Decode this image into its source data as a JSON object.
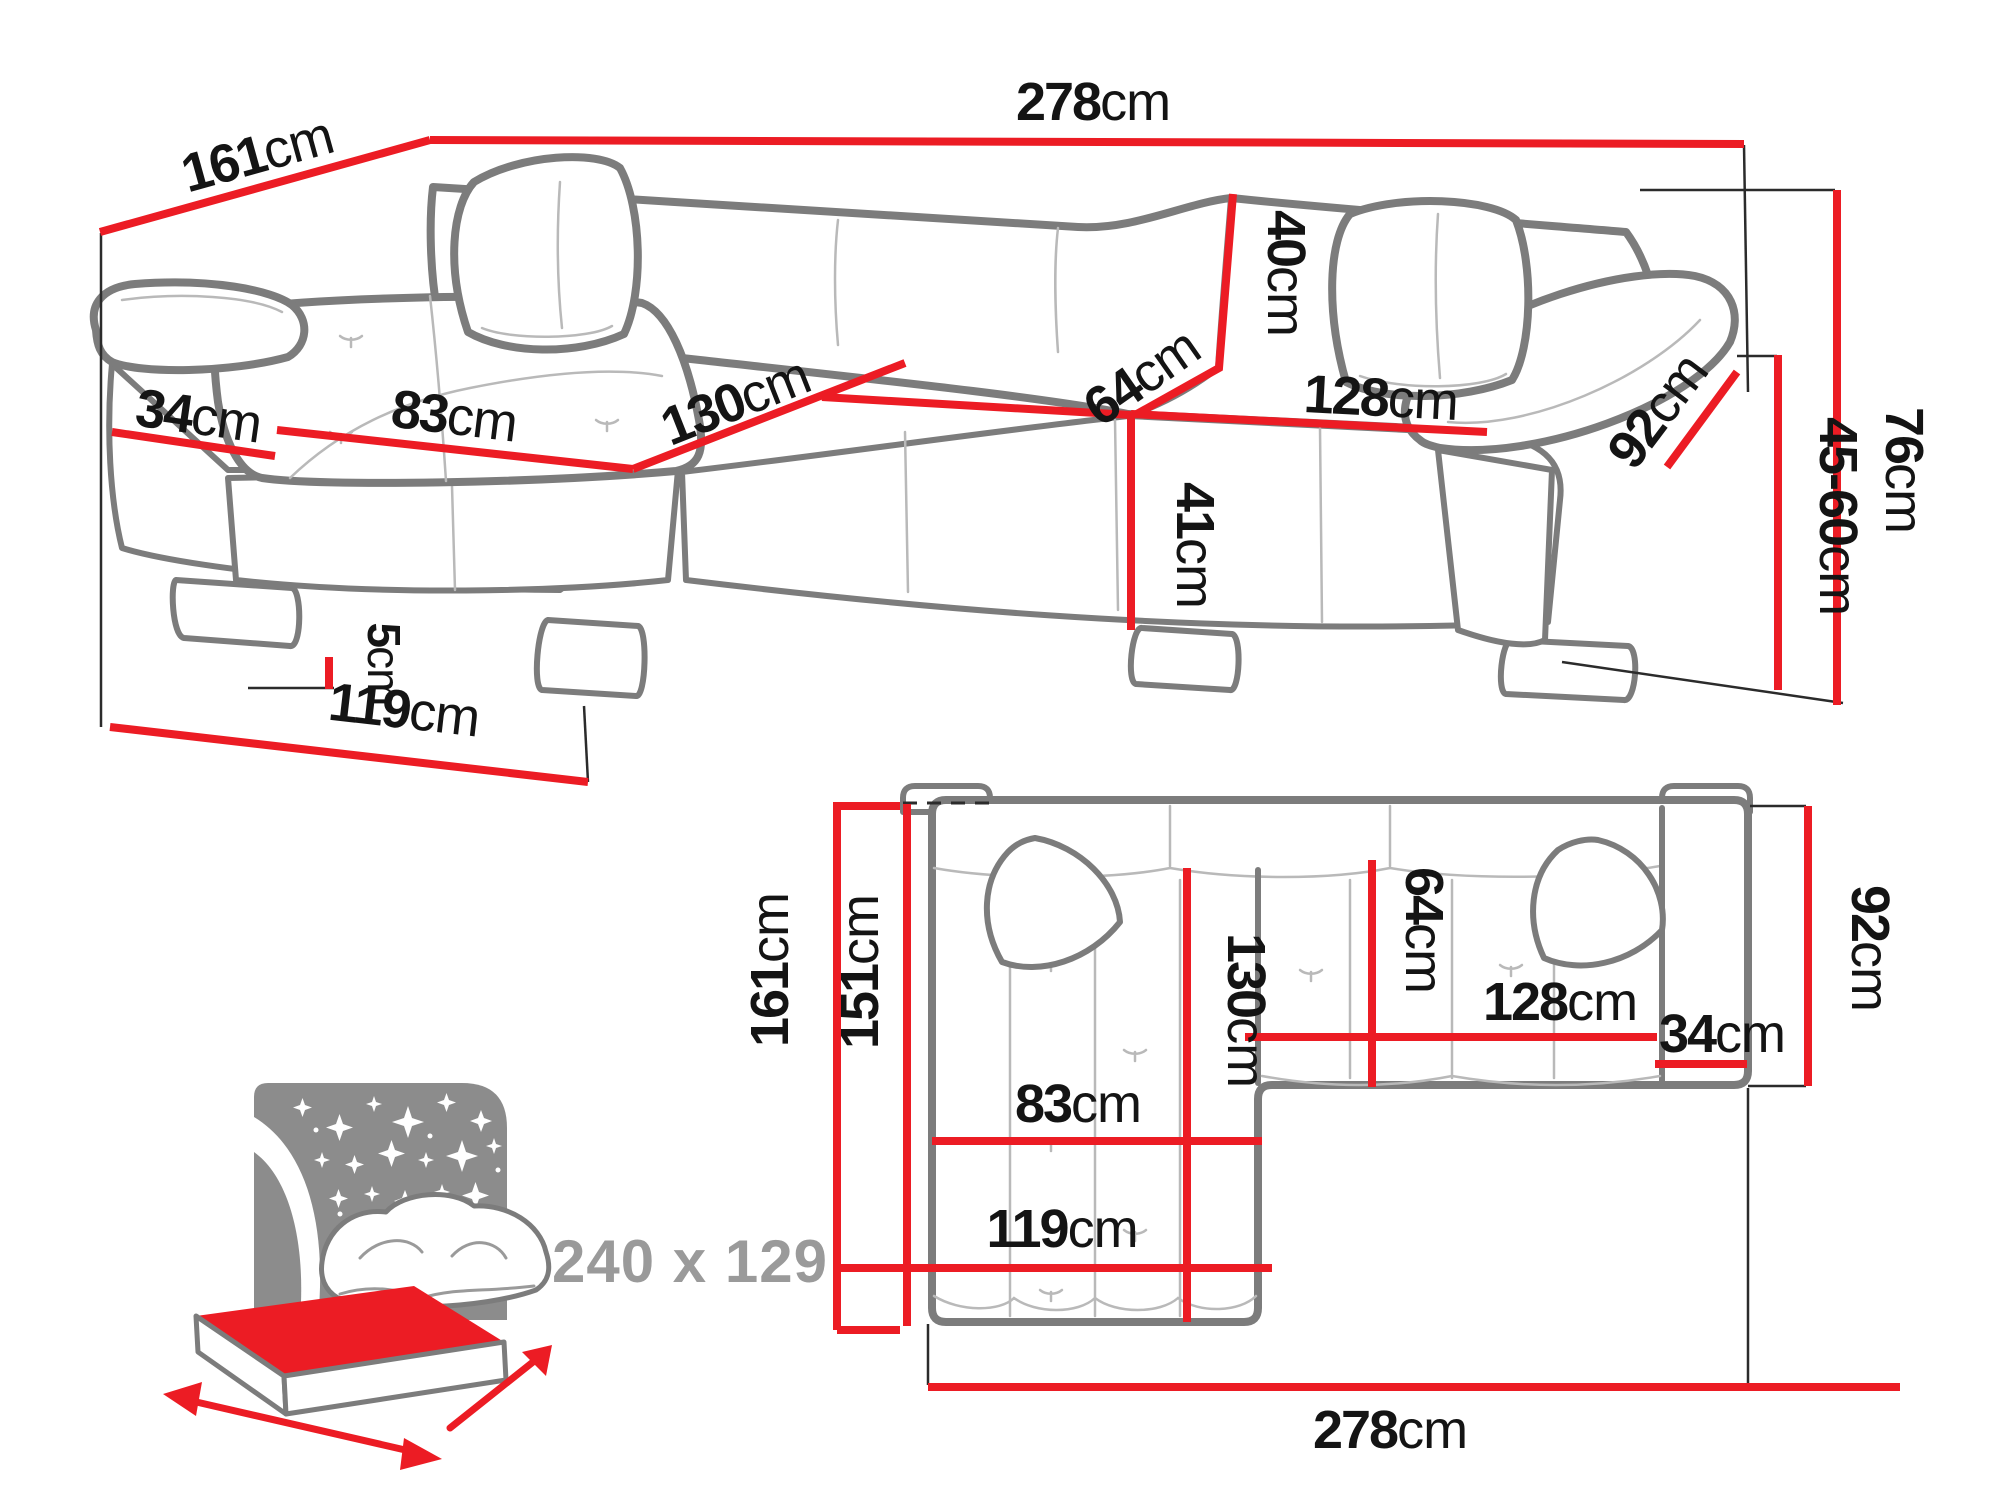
{
  "palette": {
    "dimension_red": "#ec1c24",
    "sofa_outline_gray": "#7c7c7c",
    "inner_line_gray": "#b9b9b9",
    "label_black": "#141414",
    "muted_gray": "#9a9a9a"
  },
  "perspective_view": {
    "dims": {
      "depth_total": {
        "num": "161",
        "unit": "cm"
      },
      "width_total": {
        "num": "278",
        "unit": "cm"
      },
      "armrest_width": {
        "num": "34",
        "unit": "cm"
      },
      "chaise_cushion": {
        "num": "83",
        "unit": "cm"
      },
      "chaise_length": {
        "num": "130",
        "unit": "cm"
      },
      "seat_depth": {
        "num": "64",
        "unit": "cm"
      },
      "backrest_height": {
        "num": "40",
        "unit": "cm"
      },
      "seat_width": {
        "num": "128",
        "unit": "cm"
      },
      "arm_length": {
        "num": "92",
        "unit": "cm"
      },
      "total_height": {
        "num": "76",
        "unit": "cm"
      },
      "armrest_height": {
        "num": "45-60",
        "unit": "cm"
      },
      "seat_height": {
        "num": "41",
        "unit": "cm"
      },
      "leg_height": {
        "num": "5",
        "unit": "cm"
      },
      "chaise_depth": {
        "num": "119",
        "unit": "cm"
      }
    }
  },
  "plan_view": {
    "dims": {
      "depth_total": {
        "num": "161",
        "unit": "cm"
      },
      "depth_inner": {
        "num": "151",
        "unit": "cm"
      },
      "chaise_length": {
        "num": "130",
        "unit": "cm"
      },
      "seat_depth": {
        "num": "64",
        "unit": "cm"
      },
      "seat_width": {
        "num": "128",
        "unit": "cm"
      },
      "armrest_width": {
        "num": "34",
        "unit": "cm"
      },
      "arm_depth": {
        "num": "92",
        "unit": "cm"
      },
      "chaise_cushion": {
        "num": "83",
        "unit": "cm"
      },
      "chaise_depth": {
        "num": "119",
        "unit": "cm"
      },
      "width_total": {
        "num": "278",
        "unit": "cm"
      }
    }
  },
  "sleeping_icon": {
    "sleeping_area": "240 x 129"
  }
}
